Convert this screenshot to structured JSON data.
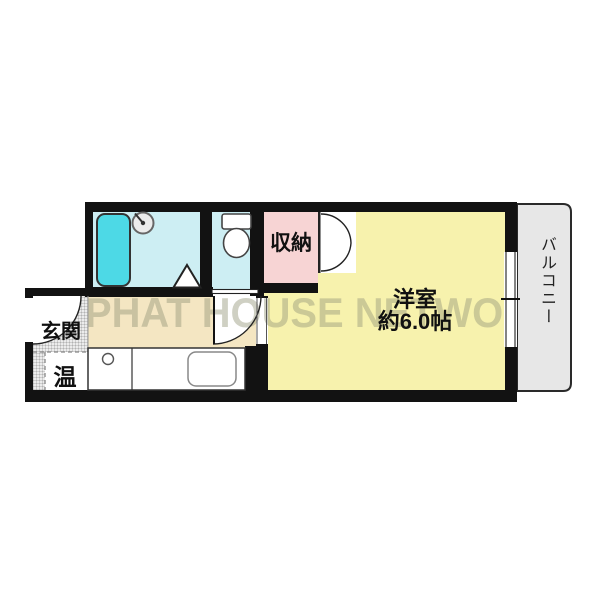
{
  "floorplan": {
    "watermark": "PHAT HOUSE NETWORK",
    "wall_color": "#121212",
    "rooms": {
      "main_room": {
        "label_line1": "洋室",
        "label_line2": "約6.0帖",
        "color": "#f7f2ad"
      },
      "balcony": {
        "label": "バルコニー",
        "color": "#e7e7e7"
      },
      "closet": {
        "label": "収納",
        "color": "#f7d4d4"
      },
      "entrance": {
        "label": "玄関"
      },
      "water_heater": {
        "label": "温"
      },
      "bathroom": {
        "color": "#cdeef3"
      },
      "toilet_room": {
        "color": "#cdeef3"
      },
      "hallway_kitchen": {
        "color": "#f4e6c2"
      }
    },
    "fixtures": {
      "bathtub_color": "#4dd9e6"
    }
  }
}
